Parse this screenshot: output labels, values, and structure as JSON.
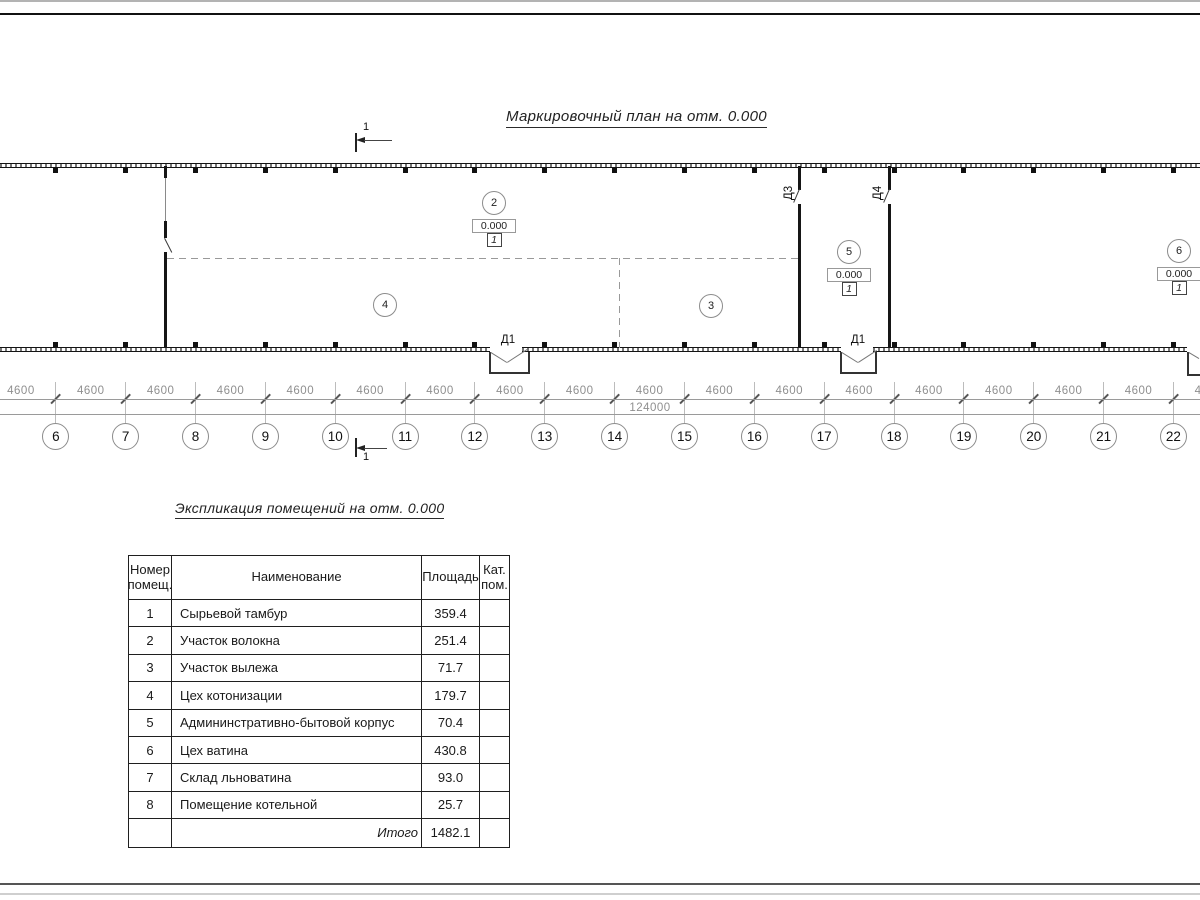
{
  "plan": {
    "title": "Маркировочный план на отм. 0.000",
    "section_mark_label": "1",
    "bay_dim_label": "4600",
    "total_dim_label": "124000",
    "grid_numbers": [
      "5",
      "6",
      "7",
      "8",
      "9",
      "10",
      "11",
      "12",
      "13",
      "14",
      "15",
      "16",
      "17",
      "18",
      "19",
      "20",
      "21",
      "22"
    ],
    "door_labels": {
      "d1": "Д1",
      "d3": "Д3",
      "d4": "Д4"
    },
    "rooms": [
      {
        "num": "2",
        "x": 494,
        "y": 203,
        "elevation": "0.000",
        "category": "1"
      },
      {
        "num": "3",
        "x": 711,
        "y": 306
      },
      {
        "num": "4",
        "x": 385,
        "y": 305
      },
      {
        "num": "5",
        "x": 849,
        "y": 252,
        "elevation": "0.000",
        "category": "1"
      },
      {
        "num": "6",
        "x": 1179,
        "y": 251,
        "elevation": "0.000",
        "category": "1"
      }
    ]
  },
  "table": {
    "title": "Экспликация помещений на отм. 0.000",
    "headers": {
      "num1": "Номер",
      "num2": "помещ.",
      "name": "Наименование",
      "area": "Площадь",
      "cat1": "Кат.",
      "cat2": "пом."
    },
    "rows": [
      {
        "num": "1",
        "name": "Сырьевой тамбур",
        "area": "359.4",
        "cat": ""
      },
      {
        "num": "2",
        "name": "Участок волокна",
        "area": "251.4",
        "cat": ""
      },
      {
        "num": "3",
        "name": "Участок вылежа",
        "area": "71.7",
        "cat": ""
      },
      {
        "num": "4",
        "name": "Цех котонизации",
        "area": "179.7",
        "cat": ""
      },
      {
        "num": "5",
        "name": "Админинстративно-бытовой корпус",
        "area": "70.4",
        "cat": ""
      },
      {
        "num": "6",
        "name": "Цех ватина",
        "area": "430.8",
        "cat": ""
      },
      {
        "num": "7",
        "name": "Склад льноватина",
        "area": "93.0",
        "cat": ""
      },
      {
        "num": "8",
        "name": "Помещение котельной",
        "area": "25.7",
        "cat": ""
      }
    ],
    "total_label": "Итого",
    "total_area": "1482.1"
  },
  "colors": {
    "wall": "#161616",
    "dim_gray": "#8f8f8f",
    "bubble_outline": "#8c8c8c",
    "frame": "#111111"
  }
}
